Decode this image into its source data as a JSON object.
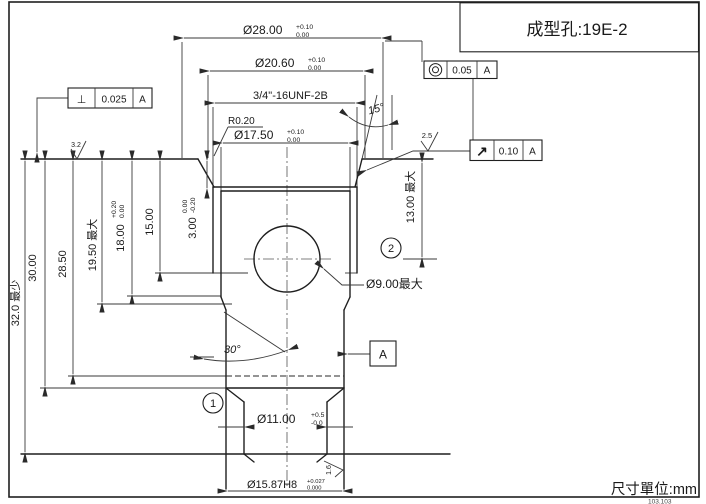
{
  "title_block": {
    "title": "成型孔:19E-2"
  },
  "footer": {
    "units_label": "尺寸單位:mm",
    "corner_note": "103.103"
  },
  "icons": {
    "perpendicularity": "⊥",
    "runout": "↗",
    "concentricity": "circle-in-circle"
  },
  "gdt": {
    "perpendicularity": {
      "value": "0.025",
      "datum": "A"
    },
    "concentricity": {
      "value": "0.05",
      "datum": "A"
    },
    "runout": {
      "value": "0.10",
      "datum": "A"
    }
  },
  "dimensions": {
    "dia28": {
      "label": "Ø28.00",
      "tol_upper": "+0.10",
      "tol_lower": "0.00"
    },
    "dia20_6": {
      "label": "Ø20.60",
      "tol_upper": "+0.10",
      "tol_lower": "0.00"
    },
    "thread": {
      "label": "3/4\"-16UNF-2B"
    },
    "dia17_5": {
      "label": "Ø17.50",
      "tol_upper": "+0.10",
      "tol_lower": "0.00"
    },
    "radius": {
      "label": "R0.20"
    },
    "angle15": {
      "label": "15°"
    },
    "angle30": {
      "label": "30°"
    },
    "depth32": {
      "label": "32.0 最少"
    },
    "depth30": {
      "label": "30.00"
    },
    "depth28_5": {
      "label": "28.50"
    },
    "depth19_5": {
      "label": "19.50 最大"
    },
    "depth18": {
      "label": "18.00",
      "tol_upper": "+0.20",
      "tol_lower": "0.00"
    },
    "depth15": {
      "label": "15.00"
    },
    "depth3": {
      "label": "3.00",
      "tol_upper": "0.00",
      "tol_lower": "-0.20"
    },
    "depth13": {
      "label": "13.00 最大"
    },
    "dia9": {
      "label": "Ø9.00最大"
    },
    "dia11": {
      "label": "Ø11.00",
      "tol_upper": "+0.5",
      "tol_lower": "-0.0"
    },
    "dia15_87": {
      "label": "Ø15.87H8",
      "tol_upper": "+0.027",
      "tol_lower": "0.000"
    }
  },
  "surface_finish": {
    "top": "3.2",
    "chamfer": "2.5",
    "bore": "1.6"
  },
  "balloons": {
    "b1": "1",
    "b2": "2"
  },
  "datum": {
    "label": "A"
  }
}
